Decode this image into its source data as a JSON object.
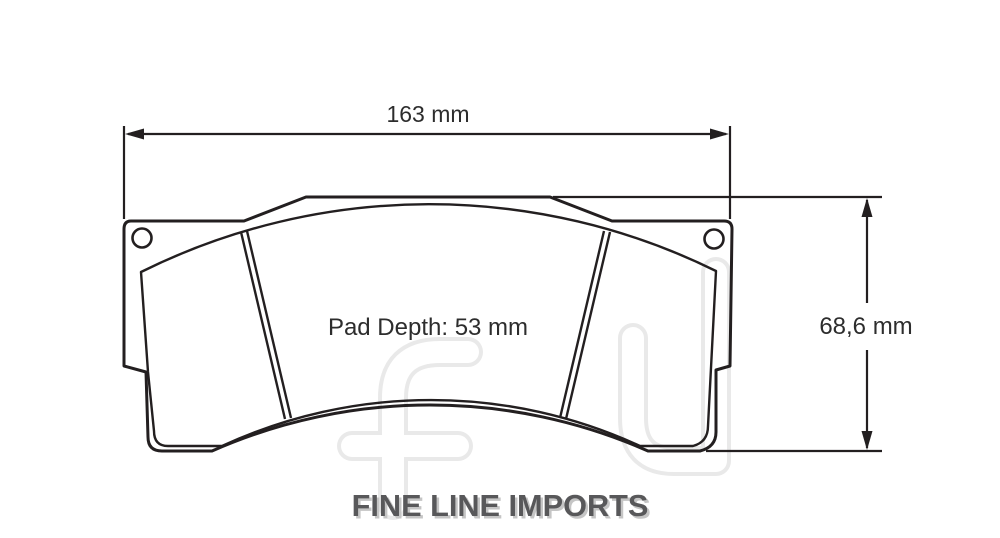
{
  "diagram": {
    "width_dimension_label": "163 mm",
    "height_dimension_label": "68,6 mm",
    "pad_depth_label": "Pad Depth: 53 mm",
    "watermark_text": "FLI"
  },
  "branding": {
    "logo_text": "FINE LINE IMPORTS"
  },
  "colors": {
    "line": "#231f20",
    "dimension_text": "#2d2d2d",
    "logo_text": "#58585a",
    "logo_shadow": "#c5c5c5",
    "watermark": "#e9e9e9",
    "background": "#ffffff"
  }
}
